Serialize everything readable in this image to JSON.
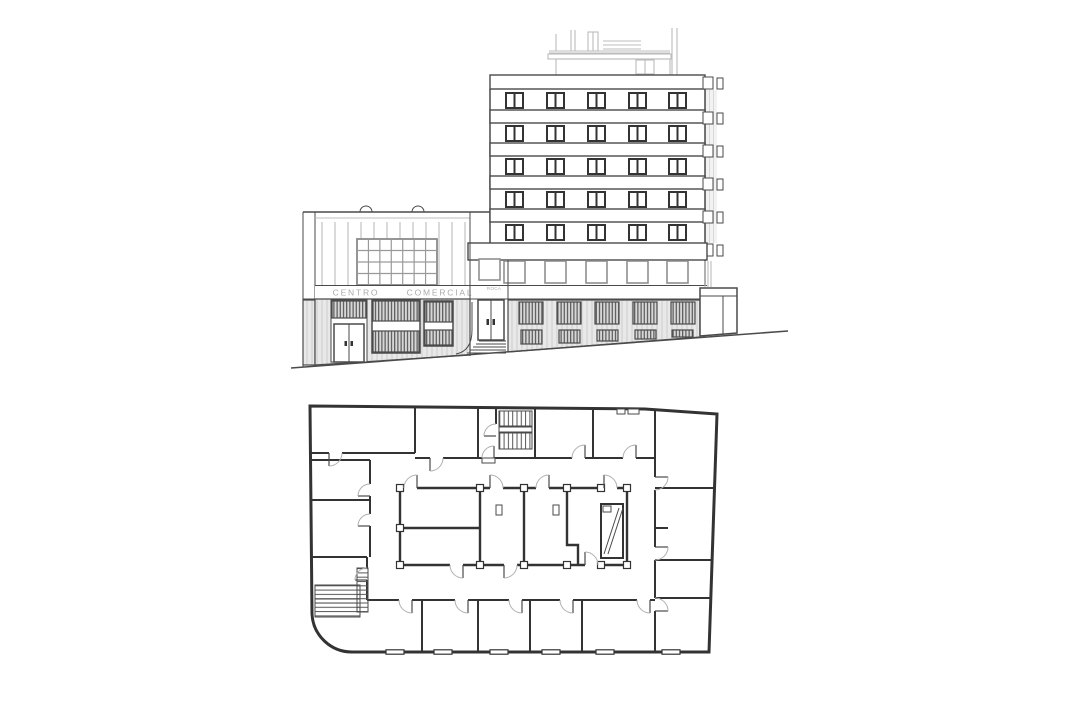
{
  "palette": {
    "background": "#ffffff",
    "ink": "#4a4a4a",
    "ink_strong": "#333333",
    "light": "#bcbcbc",
    "arc": "#b0b0b0",
    "text_gray": "#ababab"
  },
  "elevation": {
    "sign_band": {
      "word1": "CENTRO",
      "word2": "COMERCIAL",
      "entrance_sign": "ROCA"
    },
    "tower": {
      "upper_window_rows": 5,
      "windows_per_row": 5,
      "intermediate_bands": 4,
      "first_floor_windows": 5,
      "ground_upper_shutters": 5,
      "ground_lower_shutters": 5,
      "side_brackets": 6
    },
    "commercial_building": {
      "curtain_grid_cols": 7,
      "curtain_grid_rows": 4,
      "storefronts": 3,
      "roof_vents": 2
    }
  },
  "plan": {
    "stairwells": 2,
    "bottom_row_rooms": 5,
    "right_side_rooms": 4,
    "bottom_wall_windows": 6
  }
}
